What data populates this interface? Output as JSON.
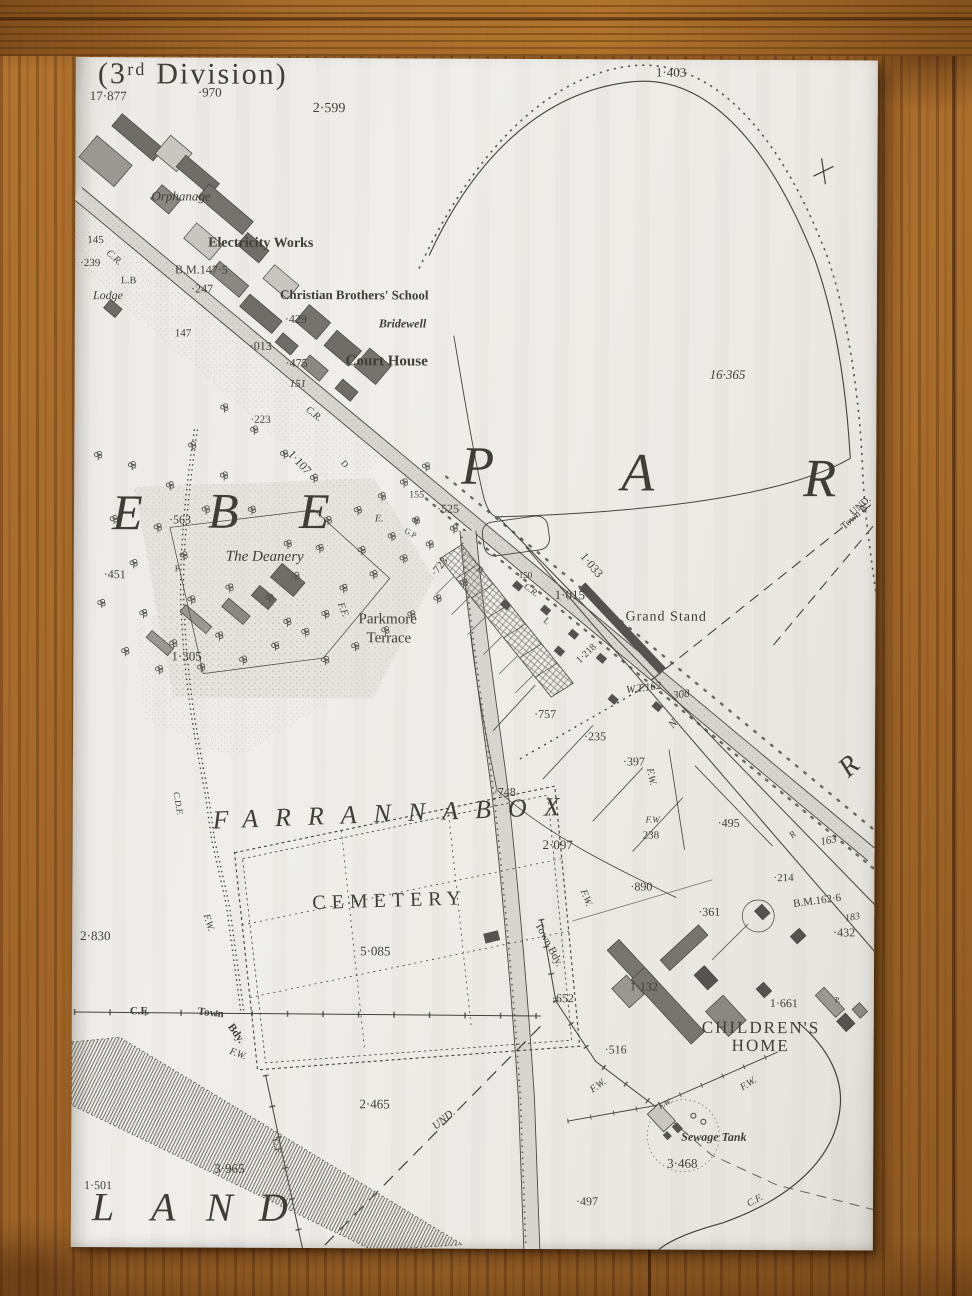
{
  "palette": {
    "wood": "#a56a2c",
    "paper": "#eceae5",
    "ink": "#403d37",
    "building_dark": "#55534f",
    "building_mid": "#77756f",
    "road_fill": "#d7d5d0"
  },
  "map": {
    "division_title": "(3ʳᵈ Division)",
    "townland_names": [
      "PAR",
      "EBE",
      "FARRANNABOX",
      "LAND",
      "R"
    ],
    "labels": [
      {
        "t": "(3ʳᵈ Division)",
        "x": 22,
        "y": 2,
        "s": 30,
        "ls": 2,
        "n": "division-title"
      },
      {
        "t": "17·877",
        "x": 14,
        "y": 32,
        "s": 13
      },
      {
        "t": "·970",
        "x": 122,
        "y": 28,
        "s": 13
      },
      {
        "t": "2·599",
        "x": 237,
        "y": 44,
        "s": 14
      },
      {
        "t": "Orphanage",
        "x": 76,
        "y": 132,
        "s": 13,
        "i": 1,
        "n": "place-label-orphanage"
      },
      {
        "t": "Electricity Works",
        "x": 133,
        "y": 179,
        "s": 14,
        "w": 700,
        "n": "place-label-electricity-works"
      },
      {
        "t": "145",
        "x": 12,
        "y": 178,
        "s": 11
      },
      {
        "t": "C.R.",
        "x": 32,
        "y": 190,
        "s": 10,
        "r": 42,
        "i": 1
      },
      {
        "t": "·239",
        "x": 5,
        "y": 201,
        "s": 11
      },
      {
        "t": "B.M.147·5",
        "x": 100,
        "y": 206,
        "s": 12,
        "n": "benchmark"
      },
      {
        "t": "L.B",
        "x": 46,
        "y": 219,
        "s": 10
      },
      {
        "t": "Lodge",
        "x": 18,
        "y": 232,
        "s": 12,
        "i": 1,
        "n": "place-label-lodge"
      },
      {
        "t": "·247",
        "x": 116,
        "y": 225,
        "s": 12
      },
      {
        "t": "Christian Brothers' School",
        "x": 205,
        "y": 230,
        "s": 13,
        "w": 700,
        "n": "place-label-school"
      },
      {
        "t": "Bridewell",
        "x": 304,
        "y": 259,
        "s": 12,
        "i": 1,
        "w": 700,
        "n": "place-label-bridewell"
      },
      {
        "t": "·429",
        "x": 210,
        "y": 255,
        "s": 12
      },
      {
        "t": "147",
        "x": 100,
        "y": 271,
        "s": 11
      },
      {
        "t": "·013",
        "x": 175,
        "y": 282,
        "s": 12
      },
      {
        "t": "·475",
        "x": 211,
        "y": 299,
        "s": 12
      },
      {
        "t": "Court House",
        "x": 271,
        "y": 296,
        "s": 15,
        "w": 700,
        "n": "place-label-court-house"
      },
      {
        "t": "151",
        "x": 215,
        "y": 321,
        "s": 11,
        "i": 1
      },
      {
        "t": "C.R.",
        "x": 232,
        "y": 346,
        "s": 10,
        "r": 38,
        "i": 1
      },
      {
        "t": "·223",
        "x": 176,
        "y": 357,
        "s": 11
      },
      {
        "t": "1·403",
        "x": 580,
        "y": 6,
        "s": 13
      },
      {
        "t": "16·365",
        "x": 635,
        "y": 308,
        "s": 13,
        "i": 1
      },
      {
        "t": "P",
        "x": 387,
        "y": 380,
        "s": 54,
        "i": 1,
        "n": "townland-letter"
      },
      {
        "t": "A",
        "x": 547,
        "y": 386,
        "s": 54,
        "i": 1,
        "n": "townland-letter"
      },
      {
        "t": "R",
        "x": 729,
        "y": 391,
        "s": 54,
        "i": 1,
        "n": "townland-letter"
      },
      {
        "t": "E",
        "x": 38,
        "y": 430,
        "s": 50,
        "i": 1,
        "n": "townland-letter"
      },
      {
        "t": "B",
        "x": 134,
        "y": 428,
        "s": 50,
        "i": 1,
        "n": "townland-letter"
      },
      {
        "t": "E",
        "x": 225,
        "y": 428,
        "s": 50,
        "i": 1,
        "n": "townland-letter"
      },
      {
        "t": "·563",
        "x": 95,
        "y": 456,
        "s": 12
      },
      {
        "t": "The Deanery",
        "x": 152,
        "y": 492,
        "s": 15,
        "i": 1,
        "n": "place-label-deanery"
      },
      {
        "t": "·451",
        "x": 30,
        "y": 511,
        "s": 12
      },
      {
        "t": "P",
        "x": 101,
        "y": 507,
        "s": 9
      },
      {
        "t": "1·305",
        "x": 98,
        "y": 592,
        "s": 13
      },
      {
        "t": "1·107",
        "x": 216,
        "y": 388,
        "s": 12,
        "r": 47
      },
      {
        "t": "D",
        "x": 268,
        "y": 399,
        "s": 9,
        "r": 47
      },
      {
        "t": "155",
        "x": 335,
        "y": 432,
        "s": 10
      },
      {
        "t": "·525",
        "x": 363,
        "y": 444,
        "s": 12
      },
      {
        "t": "U",
        "x": 339,
        "y": 459,
        "s": 8
      },
      {
        "t": "G.P",
        "x": 331,
        "y": 468,
        "s": 8,
        "r": 30
      },
      {
        "t": "E.",
        "x": 301,
        "y": 456,
        "s": 10,
        "i": 1
      },
      {
        "t": "F.F.",
        "x": 266,
        "y": 540,
        "s": 10,
        "r": 68,
        "i": 1
      },
      {
        "t": "Parkmore",
        "x": 285,
        "y": 554,
        "s": 15,
        "n": "place-label-parkmore-terrace"
      },
      {
        "t": "Terrace",
        "x": 293,
        "y": 573,
        "s": 15,
        "n": "place-label-parkmore-terrace"
      },
      {
        "t": "·723",
        "x": 360,
        "y": 511,
        "s": 11,
        "r": -52
      },
      {
        "t": "B.",
        "x": 404,
        "y": 505,
        "s": 9,
        "r": 40
      },
      {
        "t": "150",
        "x": 445,
        "y": 512,
        "s": 9
      },
      {
        "t": "C.R.",
        "x": 451,
        "y": 522,
        "s": 9,
        "r": 36,
        "i": 1
      },
      {
        "t": "1·033",
        "x": 509,
        "y": 489,
        "s": 12,
        "r": 50
      },
      {
        "t": "1·015",
        "x": 481,
        "y": 529,
        "s": 13
      },
      {
        "t": "Grand Stand",
        "x": 552,
        "y": 551,
        "s": 14,
        "ls": 1,
        "n": "place-label-grand-stand"
      },
      {
        "t": "L",
        "x": 471,
        "y": 556,
        "s": 9,
        "r": 40
      },
      {
        "t": "W.T.162",
        "x": 553,
        "y": 626,
        "s": 11,
        "i": 1,
        "r": -8
      },
      {
        "t": "308",
        "x": 600,
        "y": 631,
        "s": 11,
        "i": 1,
        "r": -8
      },
      {
        "t": "1·218",
        "x": 505,
        "y": 598,
        "s": 10,
        "r": -44
      },
      {
        "t": "·757",
        "x": 461,
        "y": 649,
        "s": 12
      },
      {
        "t": "·235",
        "x": 511,
        "y": 671,
        "s": 12
      },
      {
        "t": "·397",
        "x": 550,
        "y": 696,
        "s": 12
      },
      {
        "t": "F.W.",
        "x": 576,
        "y": 704,
        "s": 10,
        "r": 78,
        "i": 1
      },
      {
        "t": "·748",
        "x": 421,
        "y": 727,
        "s": 12
      },
      {
        "t": "FARRANNABOX",
        "x": 140,
        "y": 750,
        "s": 26,
        "i": 1,
        "ls": 17,
        "r": -2.5,
        "n": "townland-name-farrannabox"
      },
      {
        "t": "2·097",
        "x": 470,
        "y": 779,
        "s": 13
      },
      {
        "t": "F.W",
        "x": 573,
        "y": 756,
        "s": 9,
        "i": 1
      },
      {
        "t": "238",
        "x": 570,
        "y": 771,
        "s": 11
      },
      {
        "t": "N",
        "x": 598,
        "y": 662,
        "s": 11,
        "r": -48,
        "i": 1
      },
      {
        "t": "·495",
        "x": 645,
        "y": 757,
        "s": 12
      },
      {
        "t": "163",
        "x": 748,
        "y": 777,
        "s": 11,
        "i": 1,
        "r": -12
      },
      {
        "t": "R",
        "x": 770,
        "y": 698,
        "s": 28,
        "i": 1,
        "r": -42,
        "n": "townland-letter"
      },
      {
        "t": "R",
        "x": 718,
        "y": 772,
        "s": 9,
        "i": 1,
        "r": -42
      },
      {
        "t": "·214",
        "x": 701,
        "y": 813,
        "s": 11
      },
      {
        "t": "·890",
        "x": 558,
        "y": 821,
        "s": 12
      },
      {
        "t": "·361",
        "x": 626,
        "y": 846,
        "s": 12
      },
      {
        "t": "B.M.162·6",
        "x": 721,
        "y": 839,
        "s": 11,
        "r": -8,
        "n": "benchmark"
      },
      {
        "t": "183",
        "x": 773,
        "y": 854,
        "s": 10,
        "i": 1,
        "r": -10
      },
      {
        "t": "·432",
        "x": 761,
        "y": 866,
        "s": 12
      },
      {
        "t": "F.W.",
        "x": 510,
        "y": 826,
        "s": 10,
        "r": 68,
        "i": 1
      },
      {
        "t": "Town Bdy.",
        "x": 465,
        "y": 859,
        "s": 11,
        "r": 62,
        "n": "boundary-label"
      },
      {
        "t": "·652",
        "x": 480,
        "y": 933,
        "s": 12
      },
      {
        "t": "1·132",
        "x": 558,
        "y": 921,
        "s": 12
      },
      {
        "t": "1·661",
        "x": 698,
        "y": 937,
        "s": 12
      },
      {
        "t": "CHILDREN'S",
        "x": 630,
        "y": 959,
        "s": 17,
        "ls": 2,
        "n": "place-label-childrens-home"
      },
      {
        "t": "HOME",
        "x": 660,
        "y": 977,
        "s": 17,
        "ls": 2,
        "n": "place-label-childrens-home"
      },
      {
        "t": "·516",
        "x": 533,
        "y": 984,
        "s": 12
      },
      {
        "t": "P.",
        "x": 763,
        "y": 936,
        "s": 8
      },
      {
        "t": "2·830",
        "x": 8,
        "y": 872,
        "s": 13
      },
      {
        "t": "F.W.",
        "x": 133,
        "y": 852,
        "s": 10,
        "r": 72,
        "i": 1
      },
      {
        "t": "C.F.",
        "x": 58,
        "y": 949,
        "s": 11,
        "w": 600,
        "n": "boundary-label"
      },
      {
        "t": "Town",
        "x": 126,
        "y": 949,
        "s": 11,
        "w": 600,
        "r": 6,
        "n": "boundary-label"
      },
      {
        "t": "Bdy.",
        "x": 158,
        "y": 962,
        "s": 11,
        "w": 600,
        "r": 55,
        "n": "boundary-label"
      },
      {
        "t": "F.W.",
        "x": 158,
        "y": 989,
        "s": 10,
        "i": 1,
        "r": 20
      },
      {
        "t": "5·085",
        "x": 288,
        "y": 886,
        "s": 13
      },
      {
        "t": "CEMETERY",
        "x": 240,
        "y": 835,
        "s": 20,
        "ls": 6,
        "r": -2,
        "n": "place-label-cemetery"
      },
      {
        "t": "C.D.F.",
        "x": 103,
        "y": 730,
        "s": 9,
        "r": 80,
        "i": 1
      },
      {
        "t": "2·465",
        "x": 288,
        "y": 1039,
        "s": 13
      },
      {
        "t": "UND.",
        "x": 363,
        "y": 1064,
        "s": 11,
        "r": -40,
        "i": 1
      },
      {
        "t": "F.W.",
        "x": 520,
        "y": 1027,
        "s": 10,
        "r": -36,
        "i": 1
      },
      {
        "t": "F.W.",
        "x": 670,
        "y": 1024,
        "s": 10,
        "r": -32,
        "i": 1
      },
      {
        "t": "F.W.",
        "x": 588,
        "y": 1044,
        "s": 8,
        "r": -30,
        "i": 1
      },
      {
        "t": "Sewage Tank",
        "x": 610,
        "y": 1071,
        "s": 12,
        "i": 1,
        "w": 600,
        "n": "place-label-sewage-tank"
      },
      {
        "t": "3·468",
        "x": 596,
        "y": 1097,
        "s": 13
      },
      {
        "t": "·497",
        "x": 505,
        "y": 1136,
        "s": 12
      },
      {
        "t": "C.F.",
        "x": 677,
        "y": 1140,
        "s": 10,
        "r": -28,
        "i": 1
      },
      {
        "t": "3·965",
        "x": 143,
        "y": 1104,
        "s": 13
      },
      {
        "t": "1·501",
        "x": 13,
        "y": 1122,
        "s": 12
      },
      {
        "t": "C.F.",
        "x": 203,
        "y": 1076,
        "s": 10,
        "r": 76,
        "i": 1
      },
      {
        "t": "L",
        "x": 21,
        "y": 1130,
        "s": 40,
        "i": 1,
        "n": "townland-letter"
      },
      {
        "t": "A",
        "x": 80,
        "y": 1130,
        "s": 40,
        "i": 1,
        "n": "townland-letter"
      },
      {
        "t": "N",
        "x": 135,
        "y": 1130,
        "s": 40,
        "i": 1,
        "n": "townland-letter"
      },
      {
        "t": "D",
        "x": 188,
        "y": 1130,
        "s": 40,
        "i": 1,
        "n": "townland-letter"
      },
      {
        "t": "UND.",
        "x": 778,
        "y": 449,
        "s": 10,
        "r": -42
      },
      {
        "t": "Town B",
        "x": 769,
        "y": 463,
        "s": 10,
        "r": -42
      }
    ]
  }
}
